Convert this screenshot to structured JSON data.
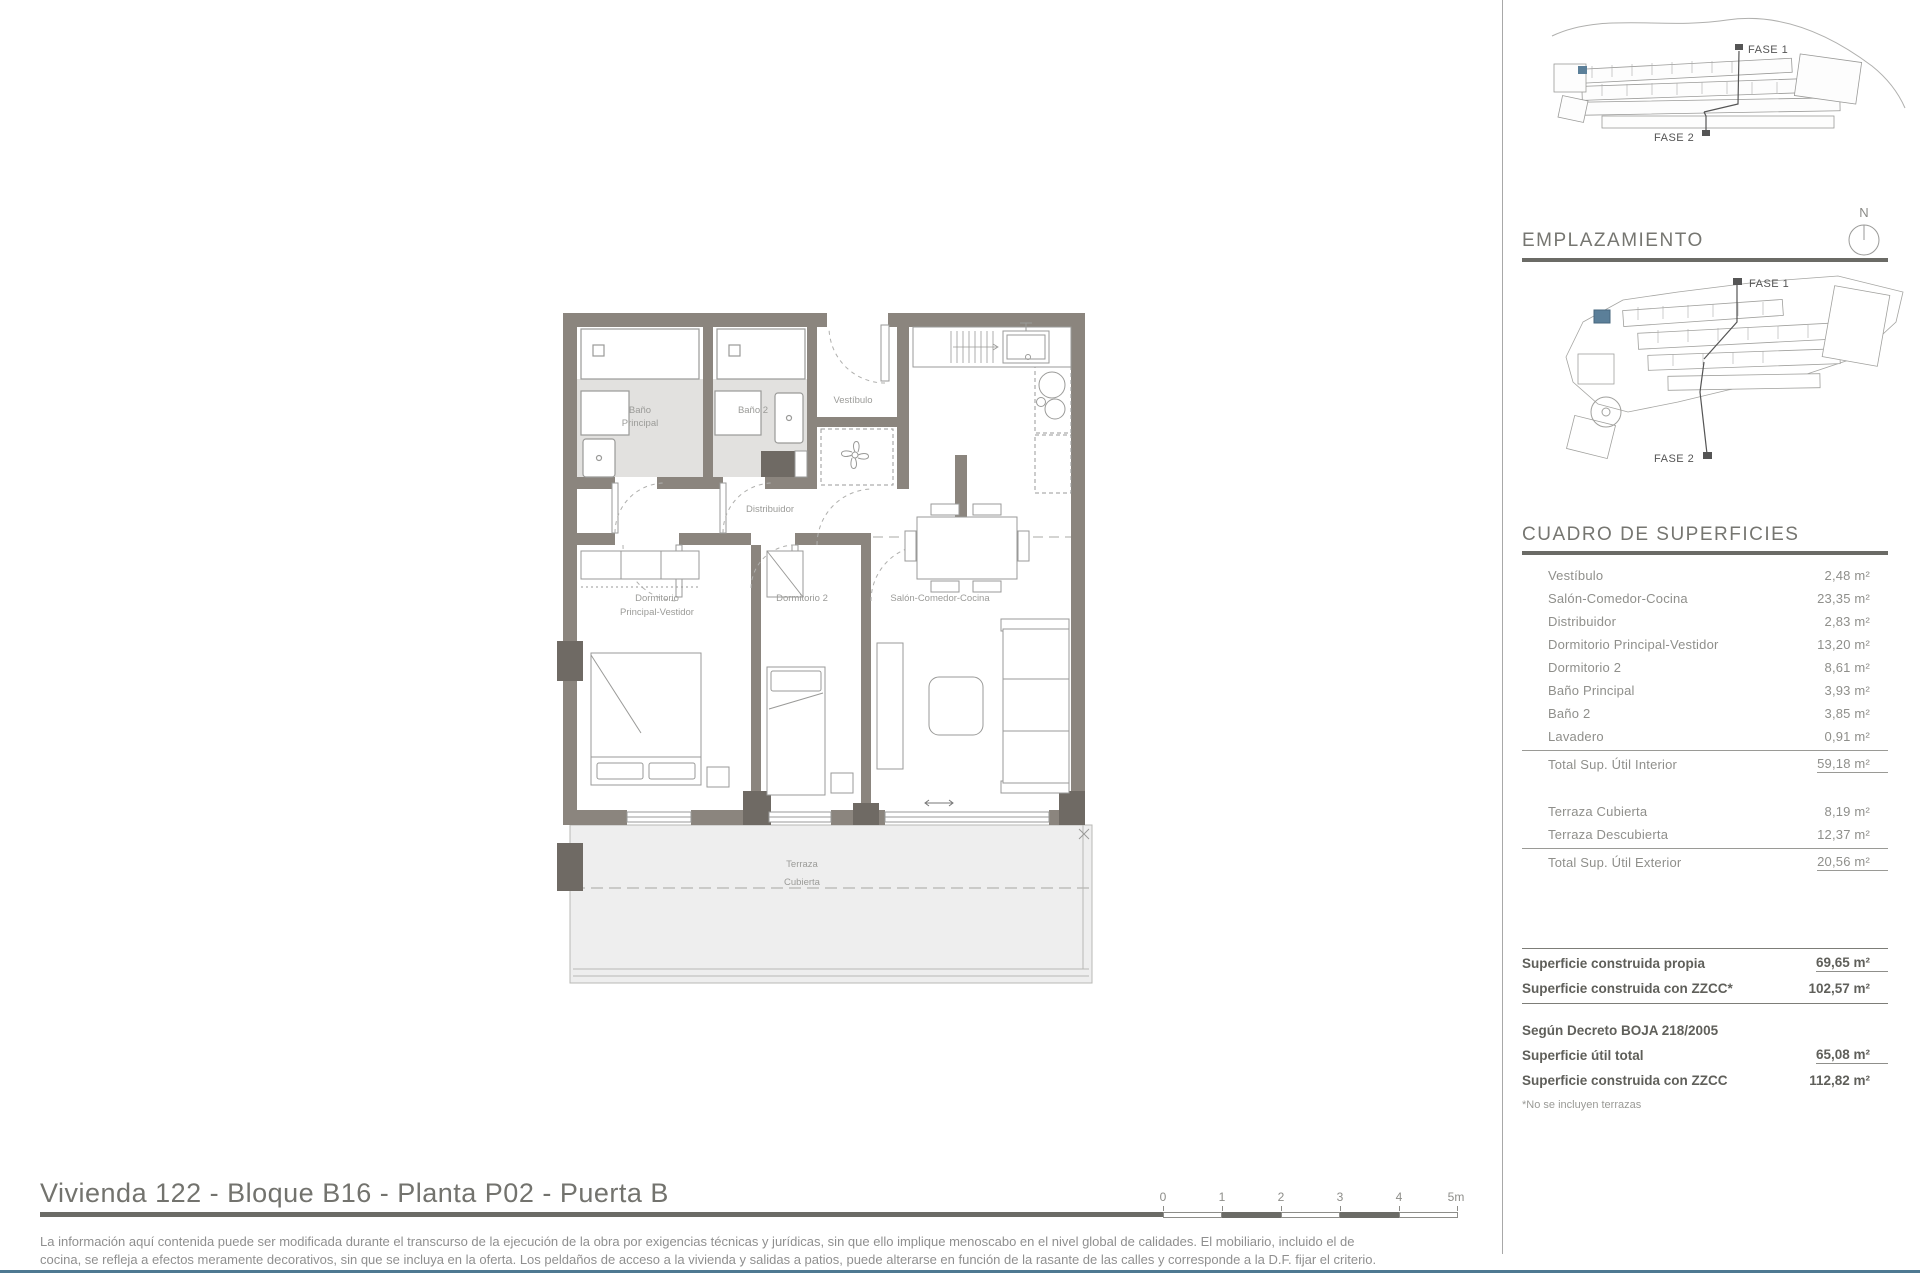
{
  "plan": {
    "labels": {
      "bano_principal": [
        "Baño",
        "Principal"
      ],
      "bano_2": "Baño 2",
      "vestibulo": "Vestíbulo",
      "distribuidor": "Distribuidor",
      "dormitorio_principal": [
        "Dormitorio",
        "Principal-Vestidor"
      ],
      "dormitorio_2": "Dormitorio 2",
      "salon": "Salón-Comedor-Cocina",
      "terraza": [
        "Terraza",
        "Cubierta"
      ]
    }
  },
  "sidebar": {
    "siteplan1": {
      "fase1": "FASE 1",
      "fase2": "FASE 2"
    },
    "emplazamiento_heading": "EMPLAZAMIENTO",
    "compass_n": "N",
    "siteplan2": {
      "fase1": "FASE 1",
      "fase2": "FASE 2"
    },
    "surfaces": {
      "heading": "CUADRO DE SUPERFICIES",
      "interior_rows": [
        {
          "label": "Vestíbulo",
          "value": "2,48 m²"
        },
        {
          "label": "Salón-Comedor-Cocina",
          "value": "23,35 m²"
        },
        {
          "label": "Distribuidor",
          "value": "2,83 m²"
        },
        {
          "label": "Dormitorio Principal-Vestidor",
          "value": "13,20 m²"
        },
        {
          "label": "Dormitorio 2",
          "value": "8,61 m²"
        },
        {
          "label": "Baño Principal",
          "value": "3,93 m²"
        },
        {
          "label": "Baño 2",
          "value": "3,85 m²"
        },
        {
          "label": "Lavadero",
          "value": "0,91 m²"
        }
      ],
      "interior_total": {
        "label": "Total Sup. Útil Interior",
        "value": "59,18 m²"
      },
      "exterior_rows": [
        {
          "label": "Terraza Cubierta",
          "value": "8,19 m²"
        },
        {
          "label": "Terraza Descubierta",
          "value": "12,37 m²"
        }
      ],
      "exterior_total": {
        "label": "Total Sup. Útil Exterior",
        "value": "20,56 m²"
      },
      "built_rows": [
        {
          "label": "Superficie construida propia",
          "value": "69,65 m²"
        },
        {
          "label": "Superficie construida con ZZCC*",
          "value": "102,57 m²"
        }
      ],
      "decree_heading": "Según Decreto BOJA 218/2005",
      "decree_rows": [
        {
          "label": "Superficie útil total",
          "value": "65,08 m²"
        },
        {
          "label": "Superficie construida con ZZCC",
          "value": "112,82 m²"
        }
      ],
      "footnote": "*No se incluyen terrazas"
    }
  },
  "footer": {
    "title": "Vivienda 122 - Bloque B16 - Planta P02 - Puerta B",
    "disclaimer_line1": "La información aquí contenida puede  ser modificada durante el transcurso de la ejecución de la obra por exigencias técnicas y jurídicas,  sin  que  ello  implique  menoscabo  en el nivel global de calidades.  El  mobiliario, incluido el de",
    "disclaimer_line2": "cocina, se refleja a efectos meramente decorativos, sin que se incluya en la oferta. Los peldaños de acceso a la vivienda y  salidas  a patios,  puede alterarse  en función de la rasante de las calles y corresponde a  la  D.F.  fijar el criterio."
  },
  "scalebar": {
    "labels": [
      "0",
      "1",
      "2",
      "3",
      "4",
      "5m"
    ]
  },
  "colors": {
    "wall": "#8b857e",
    "wall_dark": "#6f6a64",
    "bath_floor": "#e2e1df",
    "terrace_floor": "#eeeeee",
    "accent_bottom_line": "#4e7992",
    "unit_highlight": "#5b7f99"
  }
}
